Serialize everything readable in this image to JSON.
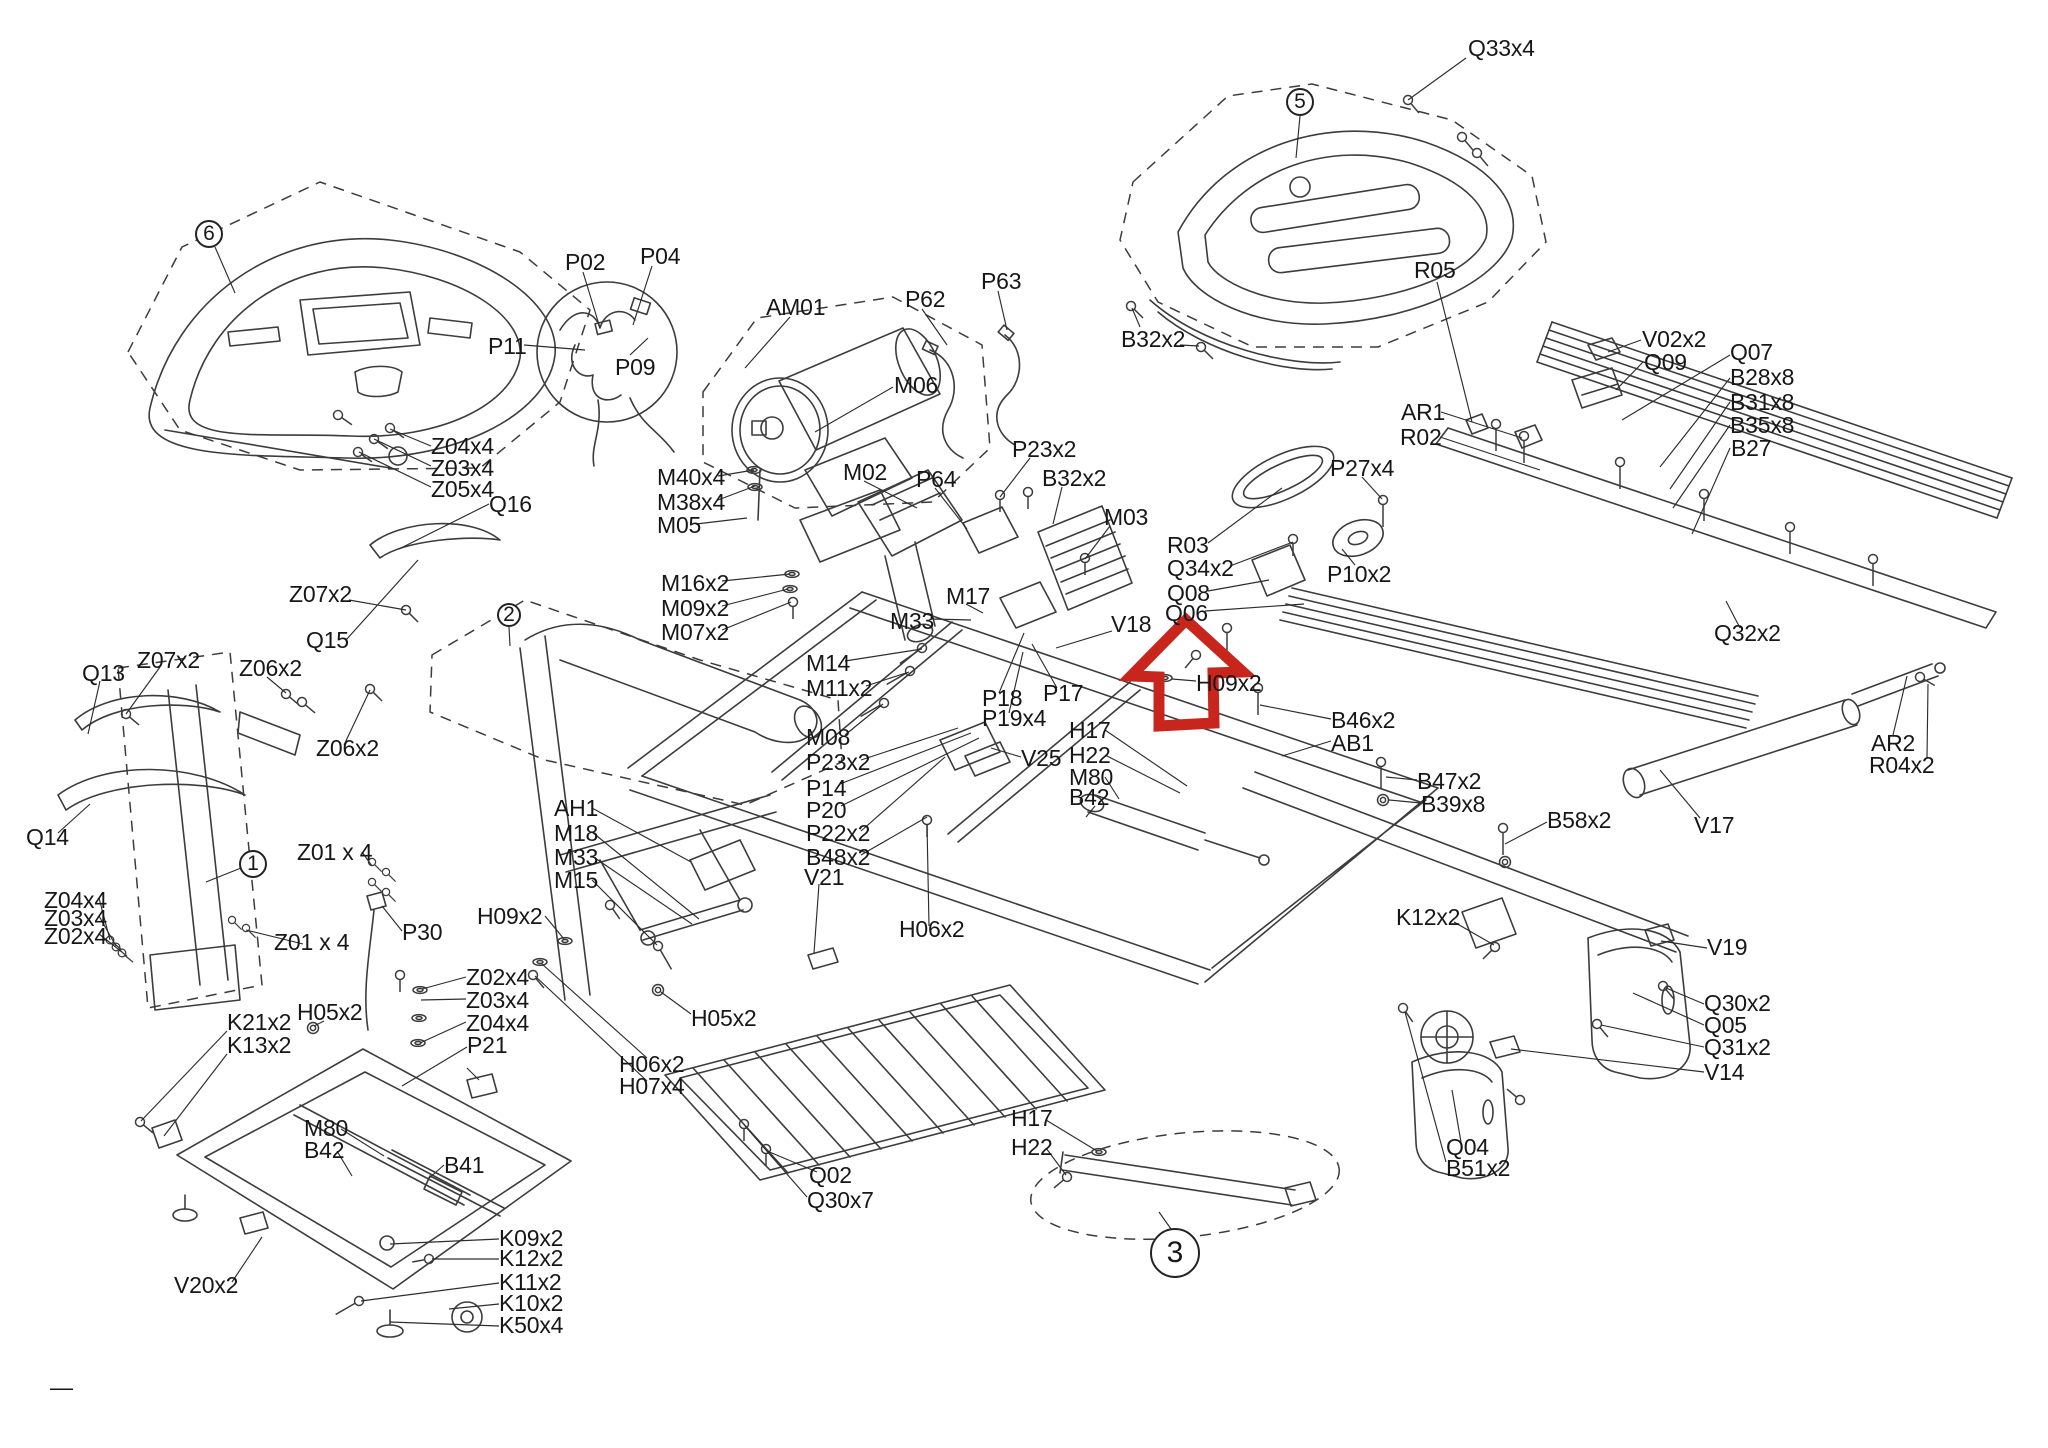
{
  "diagram": {
    "kind": "treadmill exploded parts diagram",
    "highlight": {
      "shape": "up-arrow",
      "color": "#c8251d"
    },
    "balloons": [
      {
        "text": "6",
        "cx": 209,
        "cy": 234,
        "r": 14
      },
      {
        "text": "5",
        "cx": 1300,
        "cy": 102,
        "r": 14
      },
      {
        "text": "2",
        "cx": 509,
        "cy": 615,
        "r": 12
      },
      {
        "text": "1",
        "cx": 253,
        "cy": 864,
        "r": 14
      },
      {
        "text": "3",
        "cx": 1175,
        "cy": 1253,
        "r": 25
      }
    ],
    "labels": [
      {
        "text": "Q33x4",
        "x": 1468,
        "y": 36
      },
      {
        "text": "R05",
        "x": 1414,
        "y": 258
      },
      {
        "text": "B32x2",
        "x": 1121,
        "y": 327
      },
      {
        "text": "P04",
        "x": 640,
        "y": 244
      },
      {
        "text": "P02",
        "x": 565,
        "y": 250
      },
      {
        "text": "P63",
        "x": 981,
        "y": 269
      },
      {
        "text": "P62",
        "x": 905,
        "y": 287
      },
      {
        "text": "AM01",
        "x": 766,
        "y": 295
      },
      {
        "text": "P11",
        "x": 488,
        "y": 334
      },
      {
        "text": "V02x2",
        "x": 1642,
        "y": 327
      },
      {
        "text": "Q09",
        "x": 1644,
        "y": 350
      },
      {
        "text": "Q07",
        "x": 1730,
        "y": 340
      },
      {
        "text": "P09",
        "x": 615,
        "y": 355
      },
      {
        "text": "B28x8",
        "x": 1730,
        "y": 365
      },
      {
        "text": "M06",
        "x": 894,
        "y": 373
      },
      {
        "text": "B31x8",
        "x": 1730,
        "y": 390
      },
      {
        "text": "B35x8",
        "x": 1730,
        "y": 413
      },
      {
        "text": "B27",
        "x": 1731,
        "y": 436
      },
      {
        "text": "AR1",
        "x": 1401,
        "y": 400
      },
      {
        "text": "R02",
        "x": 1400,
        "y": 425
      },
      {
        "text": "Z04x4",
        "x": 431,
        "y": 434
      },
      {
        "text": "P23x2",
        "x": 1012,
        "y": 437
      },
      {
        "text": "M02",
        "x": 843,
        "y": 460
      },
      {
        "text": "Z03x4",
        "x": 431,
        "y": 456
      },
      {
        "text": "M40x4",
        "x": 657,
        "y": 465
      },
      {
        "text": "B32x2",
        "x": 1042,
        "y": 466
      },
      {
        "text": "P64",
        "x": 916,
        "y": 467
      },
      {
        "text": "Z05x4",
        "x": 431,
        "y": 477
      },
      {
        "text": "P27x4",
        "x": 1330,
        "y": 456
      },
      {
        "text": "M38x4",
        "x": 657,
        "y": 490
      },
      {
        "text": "Q16",
        "x": 489,
        "y": 492
      },
      {
        "text": "M03",
        "x": 1104,
        "y": 505
      },
      {
        "text": "M05",
        "x": 657,
        "y": 513
      },
      {
        "text": "R03",
        "x": 1167,
        "y": 533
      },
      {
        "text": "Q34x2",
        "x": 1167,
        "y": 556
      },
      {
        "text": "P10x2",
        "x": 1327,
        "y": 562
      },
      {
        "text": "M16x2",
        "x": 661,
        "y": 571
      },
      {
        "text": "Z07x2",
        "x": 289,
        "y": 582
      },
      {
        "text": "Q08",
        "x": 1167,
        "y": 581
      },
      {
        "text": "M17",
        "x": 946,
        "y": 584
      },
      {
        "text": "M09x2",
        "x": 661,
        "y": 596
      },
      {
        "text": "Q06",
        "x": 1165,
        "y": 601
      },
      {
        "text": "M33",
        "x": 890,
        "y": 609
      },
      {
        "text": "V18",
        "x": 1111,
        "y": 612
      },
      {
        "text": "M07x2",
        "x": 661,
        "y": 620
      },
      {
        "text": "Q32x2",
        "x": 1714,
        "y": 621
      },
      {
        "text": "Q15",
        "x": 306,
        "y": 628
      },
      {
        "text": "Z07x2",
        "x": 137,
        "y": 648
      },
      {
        "text": "M14",
        "x": 806,
        "y": 651
      },
      {
        "text": "Q13",
        "x": 82,
        "y": 661
      },
      {
        "text": "Z06x2",
        "x": 239,
        "y": 656
      },
      {
        "text": "H09x2",
        "x": 1196,
        "y": 671
      },
      {
        "text": "M11x2",
        "x": 806,
        "y": 676
      },
      {
        "text": "P17",
        "x": 1043,
        "y": 681
      },
      {
        "text": "P18",
        "x": 982,
        "y": 686
      },
      {
        "text": "B46x2",
        "x": 1331,
        "y": 708
      },
      {
        "text": "P19x4",
        "x": 982,
        "y": 706
      },
      {
        "text": "H17",
        "x": 1069,
        "y": 718
      },
      {
        "text": "M08",
        "x": 806,
        "y": 725
      },
      {
        "text": "AB1",
        "x": 1331,
        "y": 731
      },
      {
        "text": "Z06x2",
        "x": 316,
        "y": 736
      },
      {
        "text": "H22",
        "x": 1069,
        "y": 743
      },
      {
        "text": "V25",
        "x": 1021,
        "y": 746
      },
      {
        "text": "P23x2",
        "x": 806,
        "y": 750
      },
      {
        "text": "M80",
        "x": 1069,
        "y": 765
      },
      {
        "text": "B47x2",
        "x": 1417,
        "y": 769
      },
      {
        "text": "P14",
        "x": 806,
        "y": 776
      },
      {
        "text": "B42",
        "x": 1069,
        "y": 785
      },
      {
        "text": "B39x8",
        "x": 1421,
        "y": 792
      },
      {
        "text": "AH1",
        "x": 554,
        "y": 796
      },
      {
        "text": "P20",
        "x": 806,
        "y": 798
      },
      {
        "text": "B58x2",
        "x": 1547,
        "y": 808
      },
      {
        "text": "V17",
        "x": 1694,
        "y": 813
      },
      {
        "text": "P22x2",
        "x": 806,
        "y": 821
      },
      {
        "text": "M18",
        "x": 554,
        "y": 821
      },
      {
        "text": "Q14",
        "x": 26,
        "y": 825
      },
      {
        "text": "AR2",
        "x": 1871,
        "y": 731
      },
      {
        "text": "Z01 x 4",
        "x": 297,
        "y": 840
      },
      {
        "text": "B48x2",
        "x": 806,
        "y": 845
      },
      {
        "text": "M33",
        "x": 554,
        "y": 845
      },
      {
        "text": "R04x2",
        "x": 1869,
        "y": 753
      },
      {
        "text": "V21",
        "x": 804,
        "y": 865
      },
      {
        "text": "M15",
        "x": 554,
        "y": 868
      },
      {
        "text": "Z04x4",
        "x": 44,
        "y": 888
      },
      {
        "text": "Z03x4",
        "x": 44,
        "y": 906
      },
      {
        "text": "H09x2",
        "x": 477,
        "y": 904
      },
      {
        "text": "K12x2",
        "x": 1396,
        "y": 905
      },
      {
        "text": "H06x2",
        "x": 899,
        "y": 917
      },
      {
        "text": "P30",
        "x": 402,
        "y": 920
      },
      {
        "text": "Z02x4",
        "x": 44,
        "y": 924
      },
      {
        "text": "Z01 x 4",
        "x": 274,
        "y": 930
      },
      {
        "text": "V19",
        "x": 1707,
        "y": 935
      },
      {
        "text": "Z02x4",
        "x": 466,
        "y": 965
      },
      {
        "text": "Z03x4",
        "x": 466,
        "y": 988
      },
      {
        "text": "Q30x2",
        "x": 1704,
        "y": 991
      },
      {
        "text": "H05x2",
        "x": 297,
        "y": 1000
      },
      {
        "text": "H05x2",
        "x": 691,
        "y": 1006
      },
      {
        "text": "K21x2",
        "x": 227,
        "y": 1010
      },
      {
        "text": "Z04x4",
        "x": 466,
        "y": 1011
      },
      {
        "text": "Q05",
        "x": 1704,
        "y": 1013
      },
      {
        "text": "P21",
        "x": 467,
        "y": 1033
      },
      {
        "text": "K13x2",
        "x": 227,
        "y": 1033
      },
      {
        "text": "Q31x2",
        "x": 1704,
        "y": 1035
      },
      {
        "text": "H06x2",
        "x": 619,
        "y": 1052
      },
      {
        "text": "V14",
        "x": 1704,
        "y": 1060
      },
      {
        "text": "H07x4",
        "x": 619,
        "y": 1074
      },
      {
        "text": "H17",
        "x": 1011,
        "y": 1106
      },
      {
        "text": "M80",
        "x": 304,
        "y": 1116
      },
      {
        "text": "H22",
        "x": 1011,
        "y": 1135
      },
      {
        "text": "Q04",
        "x": 1446,
        "y": 1135
      },
      {
        "text": "B42",
        "x": 304,
        "y": 1138
      },
      {
        "text": "B51x2",
        "x": 1446,
        "y": 1156
      },
      {
        "text": "B41",
        "x": 444,
        "y": 1153
      },
      {
        "text": "Q02",
        "x": 809,
        "y": 1163
      },
      {
        "text": "Q30x7",
        "x": 807,
        "y": 1188
      },
      {
        "text": "K09x2",
        "x": 499,
        "y": 1226
      },
      {
        "text": "K12x2",
        "x": 499,
        "y": 1246
      },
      {
        "text": "K11x2",
        "x": 499,
        "y": 1270
      },
      {
        "text": "V20x2",
        "x": 174,
        "y": 1273
      },
      {
        "text": "K10x2",
        "x": 499,
        "y": 1291
      },
      {
        "text": "K50x4",
        "x": 499,
        "y": 1313
      },
      {
        "text": "—",
        "x": 50,
        "y": 1375
      }
    ]
  }
}
